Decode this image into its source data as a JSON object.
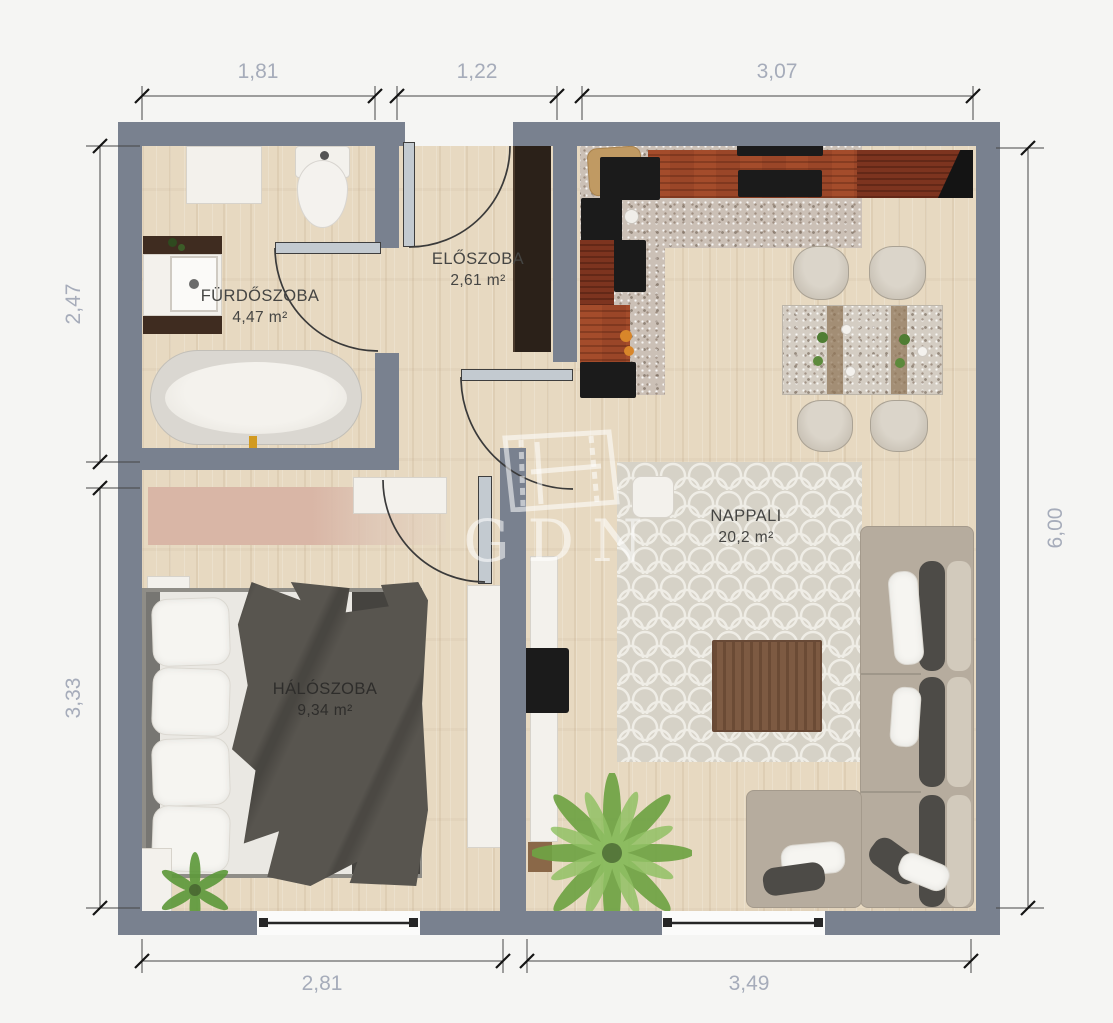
{
  "watermark": {
    "text": "GDN"
  },
  "rooms": {
    "bathroom": {
      "name": "FÜRDŐSZOBA",
      "area": "4,47 m²"
    },
    "hallway": {
      "name": "ELŐSZOBA",
      "area": "2,61 m²"
    },
    "living": {
      "name": "NAPPALI",
      "area": "20,2 m²"
    },
    "bedroom": {
      "name": "HÁLÓSZOBA",
      "area": "9,34 m²"
    }
  },
  "dimensions": {
    "top": [
      "1,81",
      "1,22",
      "3,07"
    ],
    "left": [
      "2,47",
      "3,33"
    ],
    "right": [
      "6,00"
    ],
    "bottom": [
      "2,81",
      "3,49"
    ]
  },
  "colors": {
    "wall": "#79818f",
    "wood_floor": "#e7d9c1",
    "kitchen_counter": "#9a4628",
    "dimension_text": "#a6acba"
  }
}
